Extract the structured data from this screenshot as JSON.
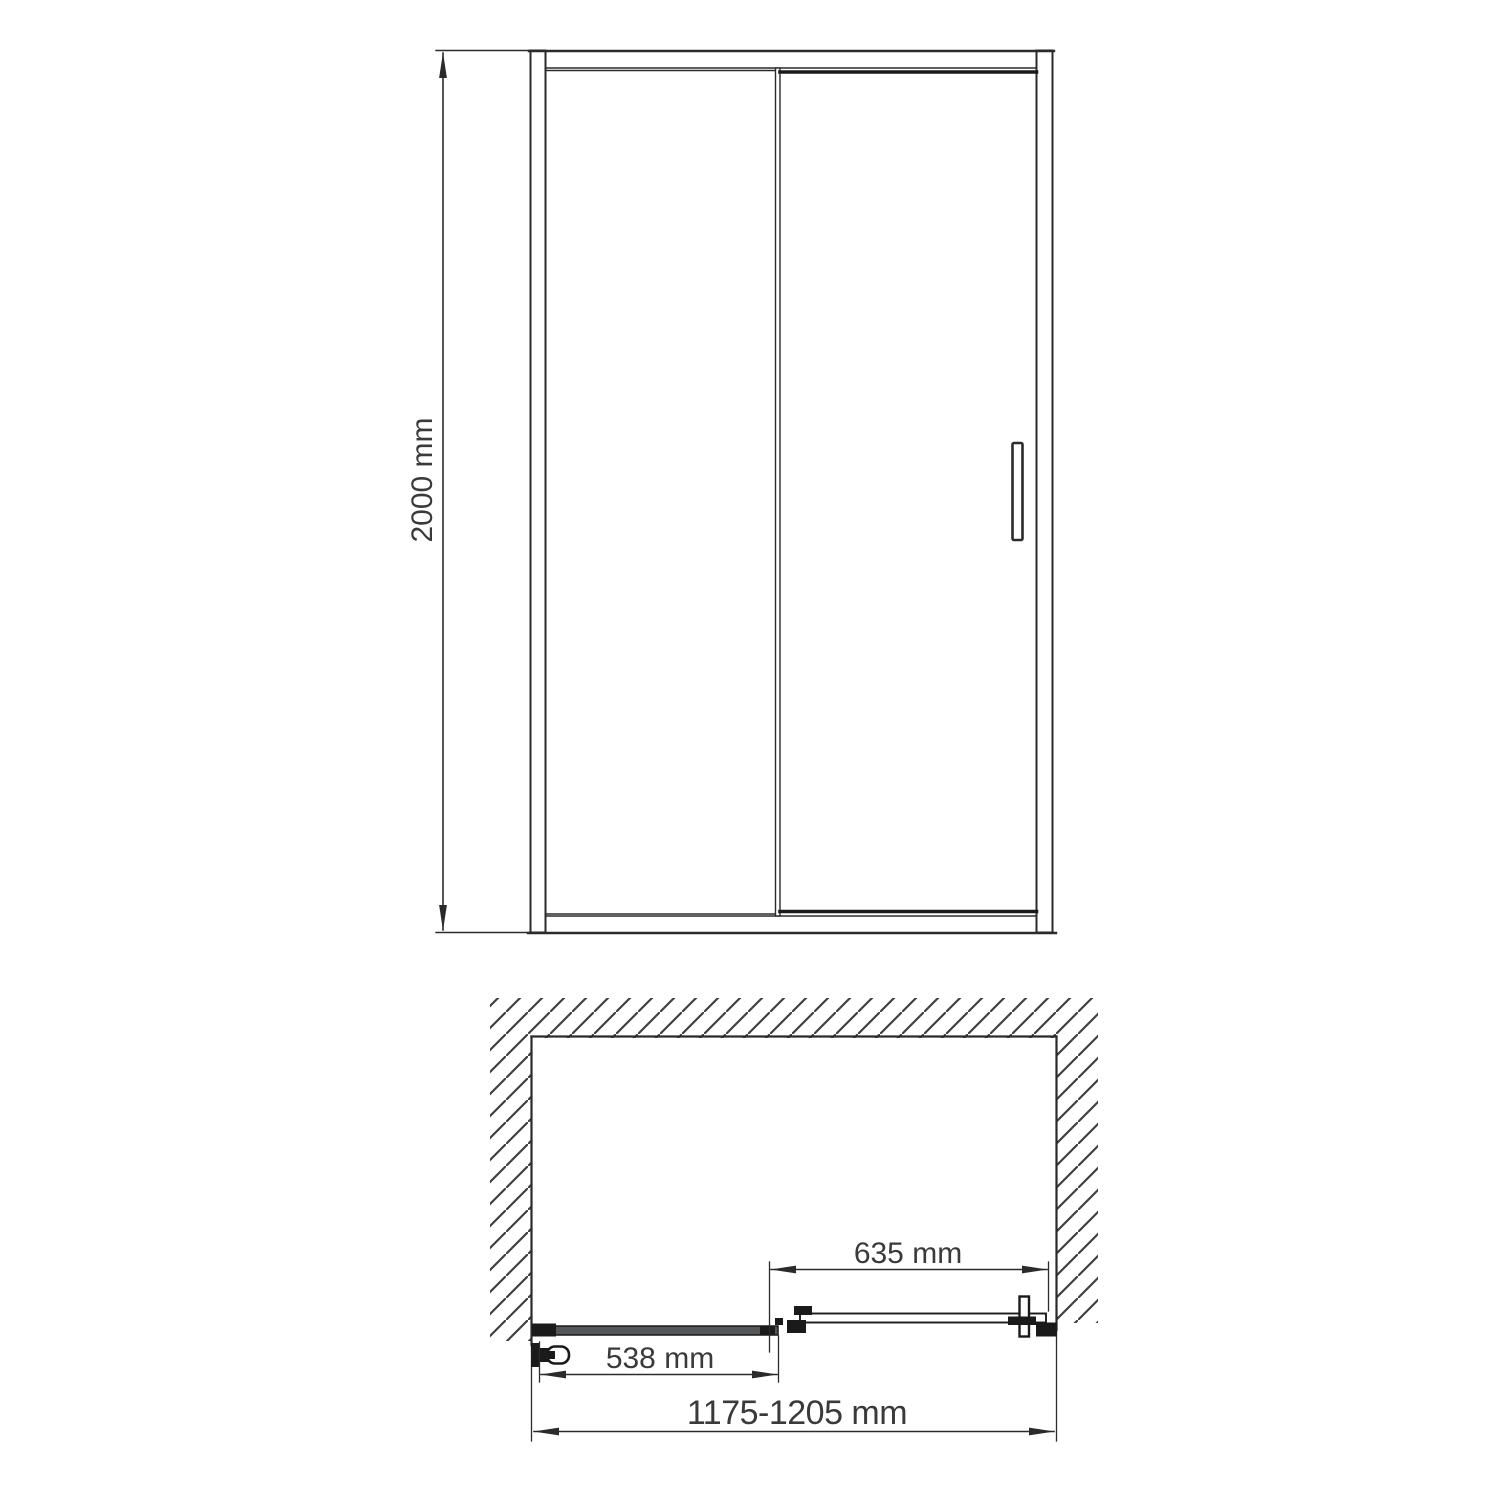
{
  "drawing": {
    "type": "technical-dimension-drawing",
    "subject": "sliding-shower-door",
    "colors": {
      "background": "#ffffff",
      "line": "#2b2b2b",
      "thick_line": "#1a1a1a",
      "text": "#3a3a3a",
      "panel_fill": "#54565a",
      "hatch": "#3f3f3f"
    },
    "front_view": {
      "name": "front-elevation",
      "height_dimension": {
        "label": "2000 mm",
        "orientation": "vertical"
      },
      "parts": [
        "wall-profile-left",
        "wall-profile-right",
        "top-rail",
        "bottom-rail",
        "fixed-glass-panel",
        "sliding-door-panel",
        "door-handle"
      ]
    },
    "plan_view": {
      "name": "top-plan",
      "dimensions": [
        {
          "label": "635 mm",
          "meaning": "sliding-door-width"
        },
        {
          "label": "538 mm",
          "meaning": "fixed-panel-width"
        },
        {
          "label": "1175-1205 mm",
          "meaning": "overall-adjustable-width"
        }
      ],
      "parts": [
        "wall-hatching",
        "fixed-glass-panel",
        "sliding-door-panel",
        "wall-bracket",
        "roller-carriage",
        "wall-profile"
      ]
    }
  }
}
